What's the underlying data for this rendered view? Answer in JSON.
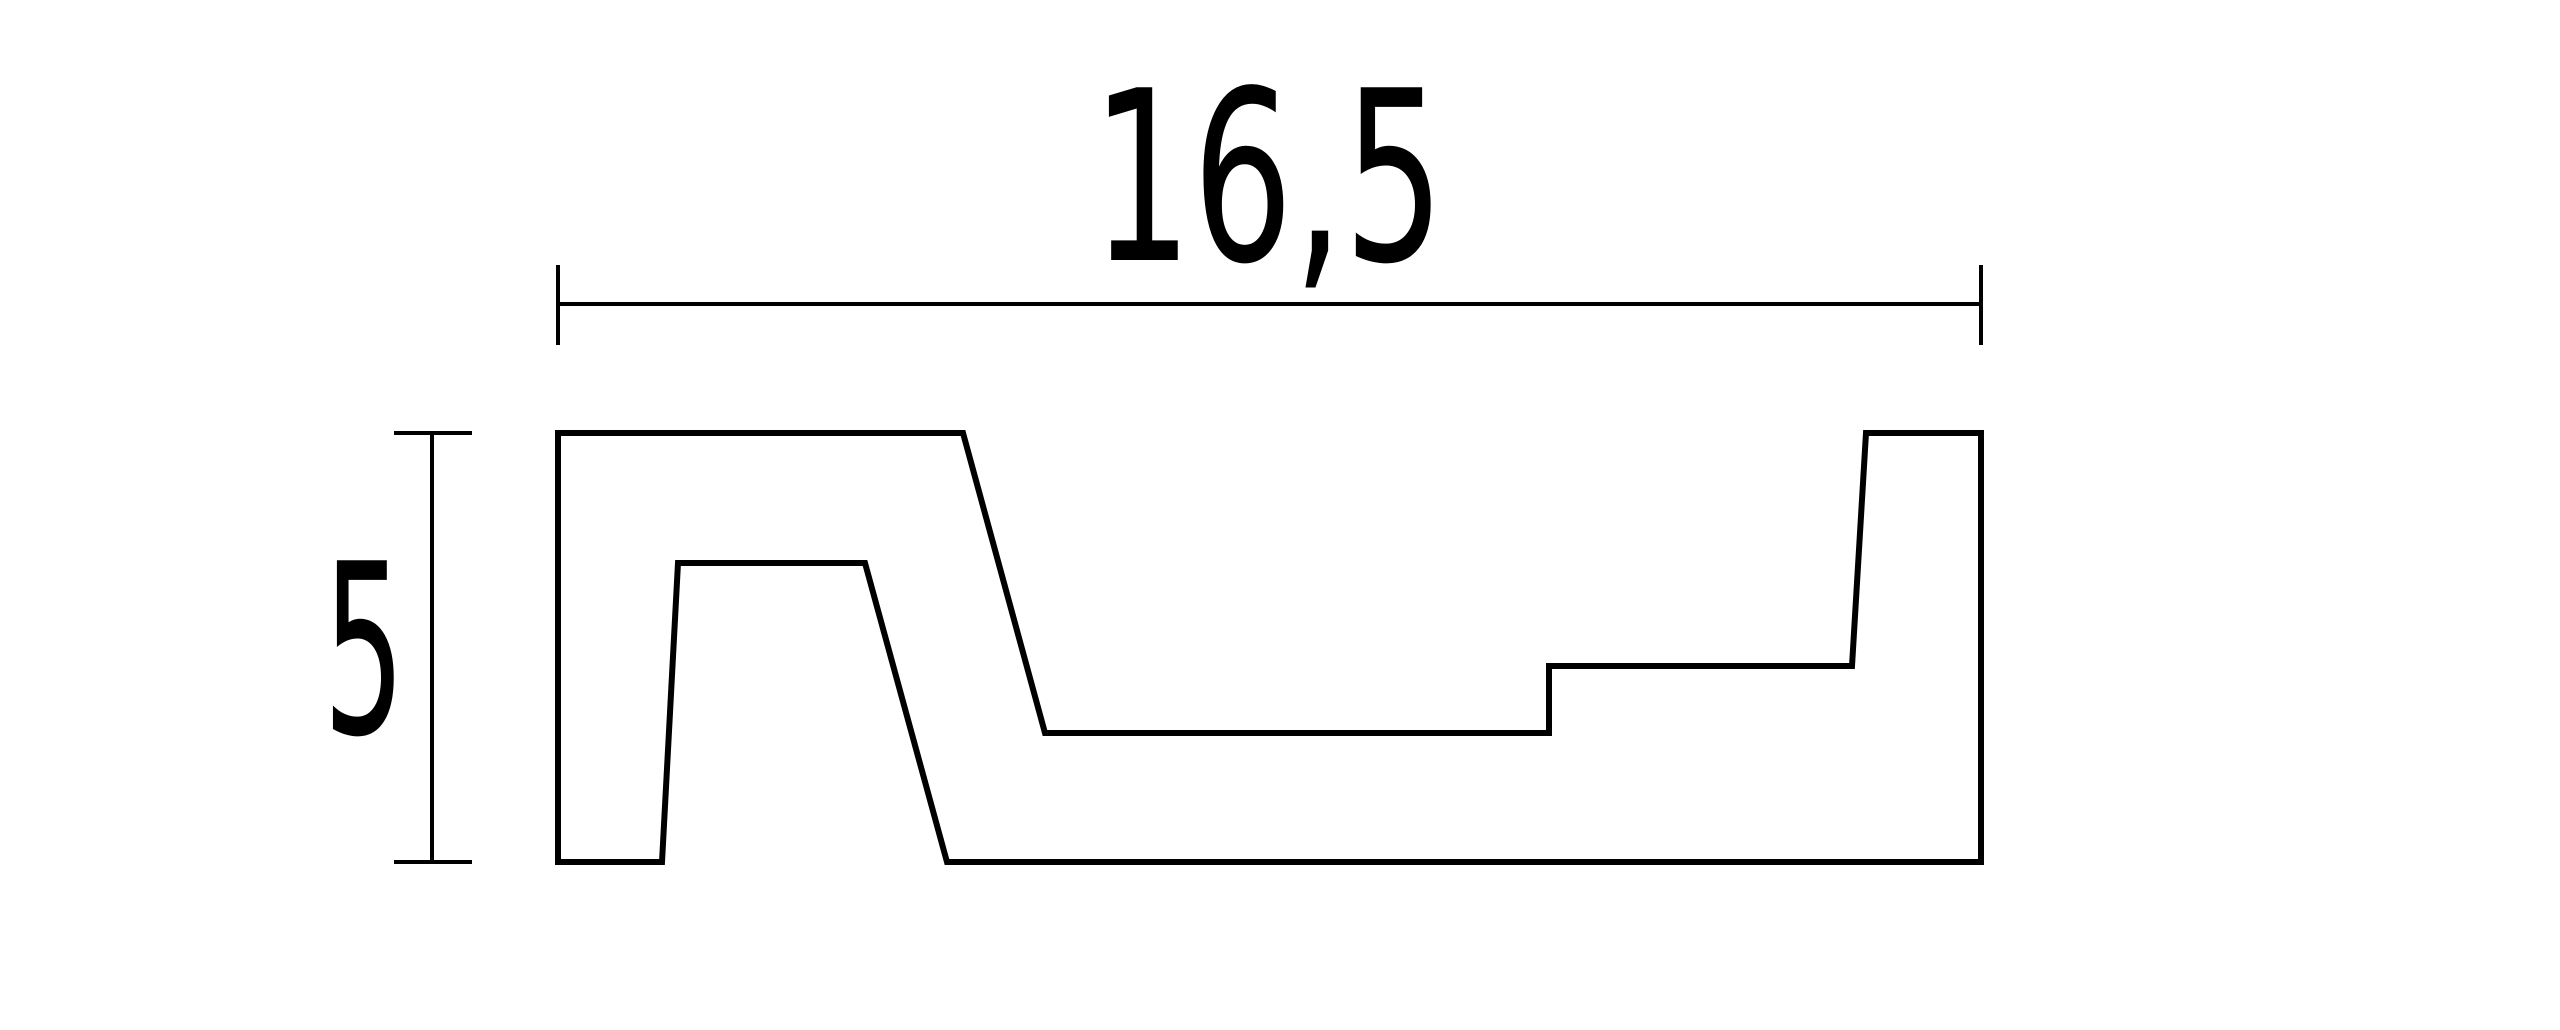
{
  "drawing": {
    "kind": "technical-drawing-cross-section",
    "background_color": "#ffffff",
    "line_color": "#000000",
    "profile": {
      "name": "board-profile-outline",
      "stroke_width": 6,
      "points": [
        [
          558,
          433
        ],
        [
          963,
          433
        ],
        [
          1045,
          733
        ],
        [
          1549,
          733
        ],
        [
          1549,
          666
        ],
        [
          1852,
          666
        ],
        [
          1866,
          433
        ],
        [
          1981,
          433
        ],
        [
          1981,
          862
        ],
        [
          947,
          862
        ],
        [
          865,
          563
        ],
        [
          678,
          563
        ],
        [
          662,
          862
        ],
        [
          558,
          862
        ]
      ]
    },
    "dimension_stroke_width": 4,
    "dimensions": {
      "width": {
        "label": "16,5",
        "value": 16.5,
        "line": [
          558,
          304,
          1981,
          304
        ],
        "ticks": [
          [
            558,
            265,
            558,
            345
          ],
          [
            1981,
            265,
            1981,
            345
          ]
        ],
        "label_anchor": [
          1268,
          260
        ],
        "label_length": 353
      },
      "height": {
        "label": "5",
        "value": 5,
        "line": [
          432,
          433,
          432,
          862
        ],
        "ticks": [
          [
            394,
            433,
            472,
            433
          ],
          [
            394,
            862,
            472,
            862
          ]
        ],
        "label_anchor": [
          364,
          733
        ],
        "label_length": 82
      }
    }
  }
}
